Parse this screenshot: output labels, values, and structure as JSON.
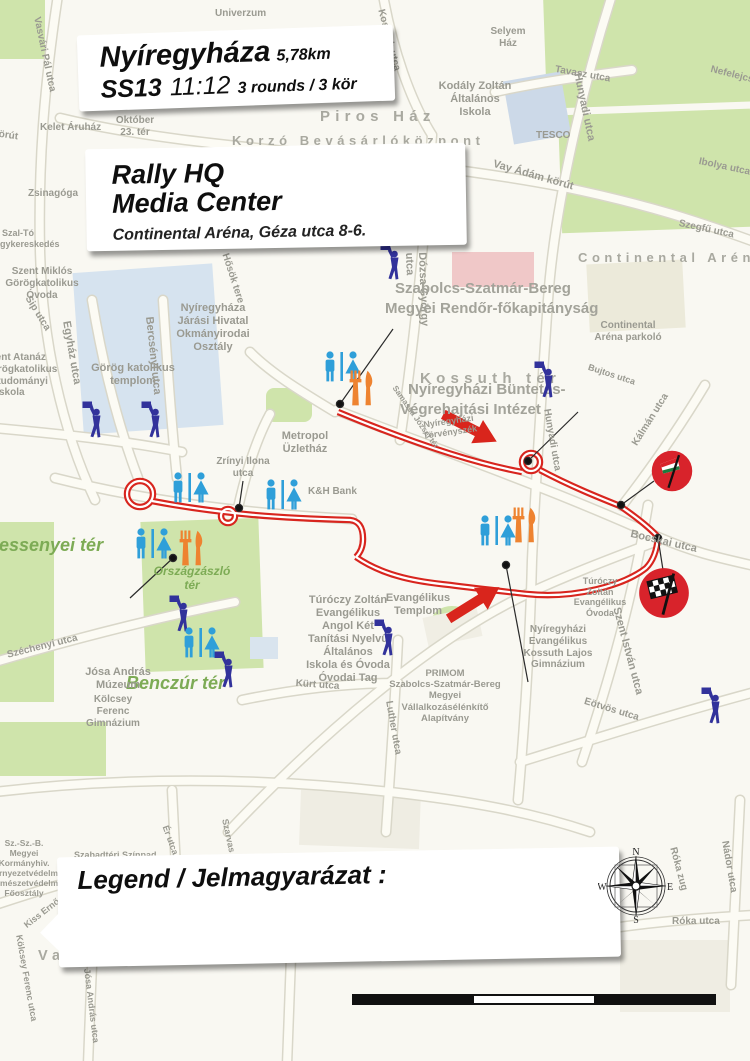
{
  "header": {
    "title": "Nyíregyháza",
    "distance": "5,78km",
    "stage": "SS13",
    "time": "11:12",
    "rounds": "3 rounds / 3 kör"
  },
  "hq": {
    "line1": "Rally HQ",
    "line2": "Media Center",
    "subtitle": "Continental Aréna, Géza utca 8-6."
  },
  "legend": {
    "title": "Legend / Jelmagyarázat :",
    "items": [
      {
        "icon": "spectator",
        "label": "Spectator spot / Nézői pont",
        "row": 0
      },
      {
        "icon": "roadclosed",
        "label": "Road closed  / Lezárt út",
        "row": 0
      },
      {
        "icon": "start",
        "label": "Start / Rajt",
        "row": 1
      },
      {
        "icon": "finish",
        "label": "Finish / Cél",
        "row": 1
      },
      {
        "icon": "buffet",
        "label": "Buffet / Büfé",
        "row": 1
      },
      {
        "icon": "toilet",
        "label": "Toilet / WC",
        "row": 1
      }
    ]
  },
  "scale_bar": {
    "labels": [
      {
        "t": "0",
        "x": 8
      },
      {
        "t": "200m",
        "x": 110
      },
      {
        "t": "400m",
        "x": 230
      },
      {
        "t": "600m",
        "x": 348
      }
    ]
  },
  "compass": {
    "n": "N",
    "e": "E",
    "s": "S",
    "w": "W"
  },
  "spots": [
    {
      "number": "13",
      "x": 506,
      "y": 682,
      "rot": -2,
      "sponsor": "tippmix"
    },
    {
      "number": "14",
      "x": 66,
      "y": 596,
      "rot": -4,
      "sponsor": "peugeot"
    },
    {
      "number": "15",
      "x": 188,
      "y": 398,
      "rot": -3,
      "sponsor": "wow"
    },
    {
      "number": "16",
      "x": 382,
      "y": 297,
      "rot": -1,
      "sponsor": null
    },
    {
      "number": "17",
      "x": 570,
      "y": 377,
      "rot": -2,
      "sponsor": "skoda"
    }
  ],
  "sponsors": {
    "wow": {
      "line1": "WOW",
      "line2": "HUNGARY"
    },
    "peugeot": {
      "name": "PEUGEOT"
    },
    "skoda": {
      "dealer": "Platán Autóház",
      "tagline": "Mindenünk az autó",
      "brand": "ŠKODA"
    },
    "tippmix": {
      "part1": "TiPP",
      "part2": "MIX"
    }
  },
  "route_notes": [
    {
      "t": "3x",
      "x": 446,
      "y": 383,
      "s": 26
    },
    {
      "t": "3x",
      "x": 448,
      "y": 622,
      "s": 23
    }
  ],
  "map_labels": [
    {
      "t": "Univerzum",
      "x": 215,
      "y": 8,
      "s": 10
    },
    {
      "t": "Selyem\nHáz",
      "x": 508,
      "y": 26,
      "s": 10,
      "c": "c"
    },
    {
      "t": "Kodály Zoltán\nÁltalános\nIskola",
      "x": 475,
      "y": 80,
      "s": 11,
      "c": "c"
    },
    {
      "t": "Tavasz utca",
      "x": 556,
      "y": 64,
      "s": 10,
      "r": 10
    },
    {
      "t": "TESCO",
      "x": 536,
      "y": 130,
      "s": 10
    },
    {
      "t": "Hunyadi utca",
      "x": 583,
      "y": 72,
      "s": 11,
      "r": 78
    },
    {
      "t": "Nefelejcs utca",
      "x": 712,
      "y": 64,
      "s": 10,
      "r": 14
    },
    {
      "t": "Ibolya utca",
      "x": 700,
      "y": 156,
      "s": 10,
      "r": 12
    },
    {
      "t": "Szegfű utca",
      "x": 680,
      "y": 218,
      "s": 10,
      "r": 12
    },
    {
      "t": "Vay Ádám körút",
      "x": 495,
      "y": 158,
      "s": 11,
      "r": 16
    },
    {
      "t": "körút",
      "x": -6,
      "y": 128,
      "s": 10,
      "r": 8
    },
    {
      "t": "Piros Ház",
      "x": 320,
      "y": 108,
      "s": 15,
      "c": "sp"
    },
    {
      "t": "Korzó Bevásárlóközpont",
      "x": 232,
      "y": 133,
      "s": 13,
      "c": "sp"
    },
    {
      "t": "Kelet Áruház",
      "x": 40,
      "y": 122,
      "s": 10
    },
    {
      "t": "Október\n23. tér",
      "x": 135,
      "y": 115,
      "s": 10,
      "c": "c"
    },
    {
      "t": "Zsinagóga",
      "x": 28,
      "y": 188,
      "s": 10
    },
    {
      "t": "Szal-Tó\nItalnagykereskedés",
      "x": 18,
      "y": 228,
      "s": 9,
      "c": "c"
    },
    {
      "t": "Szent Miklós\nGörögkatolikus\nÓvoda",
      "x": 42,
      "y": 266,
      "s": 10,
      "c": "c"
    },
    {
      "t": "Sip utca",
      "x": 32,
      "y": 294,
      "s": 10,
      "r": 58
    },
    {
      "t": "Szent Atanáz\nGörögkatolikus\nHittudományi\nFőiskola",
      "x": -16,
      "y": 352,
      "s": 10
    },
    {
      "t": "Egyház utca",
      "x": 72,
      "y": 320,
      "s": 11,
      "r": 80
    },
    {
      "t": "Bercsényi utca",
      "x": 155,
      "y": 316,
      "s": 11,
      "r": 84
    },
    {
      "t": "Görög katolikus\ntemplom",
      "x": 133,
      "y": 362,
      "s": 11,
      "c": "c"
    },
    {
      "t": "Nyíregyháza\nJárási Hivatal\nOkmányirodai\nOsztály",
      "x": 213,
      "y": 302,
      "s": 11,
      "c": "c"
    },
    {
      "t": "Hősök tere",
      "x": 230,
      "y": 252,
      "s": 10,
      "r": 72
    },
    {
      "t": "Kossuth tér",
      "x": 420,
      "y": 370,
      "s": 15,
      "c": "sp"
    },
    {
      "t": "Metropol\nÜzletház",
      "x": 305,
      "y": 430,
      "s": 11,
      "c": "c"
    },
    {
      "t": "Zrínyi Ilona\nutca",
      "x": 243,
      "y": 456,
      "s": 10,
      "c": "c"
    },
    {
      "t": "K&H Bank",
      "x": 308,
      "y": 486,
      "s": 10
    },
    {
      "t": "Dózsa György\nutca",
      "x": 428,
      "y": 252,
      "s": 11,
      "r": 88
    },
    {
      "t": "Szabolcs-Szatmár-Bereg",
      "x": 395,
      "y": 280,
      "s": 15,
      "c": "b"
    },
    {
      "t": "Megyei Rendőr-főkapitányság",
      "x": 385,
      "y": 300,
      "s": 15,
      "c": "b"
    },
    {
      "t": "Continental Aréna",
      "x": 578,
      "y": 250,
      "s": 13,
      "c": "sp"
    },
    {
      "t": "Continental\nAréna parkoló",
      "x": 628,
      "y": 320,
      "s": 10,
      "c": "c"
    },
    {
      "t": "Nyíregyházi Büntetés-",
      "x": 408,
      "y": 381,
      "s": 15,
      "c": "b"
    },
    {
      "t": "Végrehajtási Intézet",
      "x": 400,
      "y": 401,
      "s": 15,
      "c": "b"
    },
    {
      "t": "Nyíregyházi\nTörvényszék",
      "x": 448,
      "y": 420,
      "s": 9,
      "r": -8,
      "c": "c"
    },
    {
      "t": "Hunyadi utca",
      "x": 552,
      "y": 408,
      "s": 10,
      "r": 80
    },
    {
      "t": "Bujtos utca",
      "x": 590,
      "y": 362,
      "s": 9,
      "r": 18
    },
    {
      "t": "Samassa József tér",
      "x": 398,
      "y": 384,
      "s": 8,
      "r": 55
    },
    {
      "t": "Bocskai utca",
      "x": 632,
      "y": 528,
      "s": 11,
      "r": 13
    },
    {
      "t": "Kálmán utca",
      "x": 630,
      "y": 442,
      "s": 10,
      "r": -58
    },
    {
      "t": "Szent István utca",
      "x": 622,
      "y": 606,
      "s": 11,
      "r": 75
    },
    {
      "t": "Eötvös utca",
      "x": 586,
      "y": 696,
      "s": 10,
      "r": 17
    },
    {
      "t": "Bessenyei tér",
      "x": -14,
      "y": 535,
      "s": 18,
      "c": "grn"
    },
    {
      "t": "Országzászló\ntér",
      "x": 192,
      "y": 564,
      "s": 12,
      "c": "grn c"
    },
    {
      "t": "Benczúr tér",
      "x": 126,
      "y": 673,
      "s": 18,
      "c": "grn"
    },
    {
      "t": "Széchenyi utca",
      "x": 6,
      "y": 650,
      "s": 10,
      "r": -14
    },
    {
      "t": "Kürt utca",
      "x": 296,
      "y": 678,
      "s": 10,
      "r": 4
    },
    {
      "t": "Luther utca",
      "x": 394,
      "y": 700,
      "s": 10,
      "r": 80
    },
    {
      "t": "Evangélikus\nTemplom",
      "x": 418,
      "y": 592,
      "s": 11,
      "c": "c"
    },
    {
      "t": "Túróczy Zoltán\nEvangélikus\nAngol Két\nTanítási Nyelvű\nÁltalános\nIskola és Óvoda\nÓvodai Tag",
      "x": 348,
      "y": 594,
      "s": 11,
      "c": "c"
    },
    {
      "t": "PRIMOM\nSzabolcs-Szatmár-Bereg\nMegyei\nVállalkozásélénkítő\nAlapítvány",
      "x": 445,
      "y": 668,
      "s": 9.5,
      "c": "c"
    },
    {
      "t": "Nyíregyházi\nEvangélikus\nKossuth Lajos\nGimnázium",
      "x": 558,
      "y": 624,
      "s": 10,
      "c": "c"
    },
    {
      "t": "Túróczy\nZoltán\nEvangélikus\nÓvoda",
      "x": 600,
      "y": 576,
      "s": 9,
      "c": "c"
    },
    {
      "t": "Kölcsey\nFerenc\nGimnázium",
      "x": 113,
      "y": 694,
      "s": 10,
      "c": "c"
    },
    {
      "t": "Jósa András\nMúzeum",
      "x": 118,
      "y": 666,
      "s": 11,
      "c": "c"
    },
    {
      "t": "Sz.-Sz.-B.\nMegyei\nKormányhiv.\nKörnyezetvédelmi\nTermészetvédelmi\nFőosztály",
      "x": 24,
      "y": 838,
      "s": 8.5,
      "c": "c"
    },
    {
      "t": "Szabadtéri Színpad",
      "x": 74,
      "y": 850,
      "s": 9
    },
    {
      "t": "Vasvári Pál Gimnázium",
      "x": 38,
      "y": 948,
      "s": 14.5,
      "c": "sp"
    },
    {
      "t": "Róka zug",
      "x": 678,
      "y": 846,
      "s": 10,
      "r": 75
    },
    {
      "t": "Nádor utca",
      "x": 730,
      "y": 840,
      "s": 10,
      "r": 80
    },
    {
      "t": "Róka utca",
      "x": 672,
      "y": 916,
      "s": 10
    },
    {
      "t": "Ér utca",
      "x": 170,
      "y": 824,
      "s": 9,
      "r": 70
    },
    {
      "t": "Szarvas utca",
      "x": 230,
      "y": 818,
      "s": 9,
      "r": 78
    },
    {
      "t": "Vasvári Pál utca",
      "x": 42,
      "y": 16,
      "s": 10,
      "r": 78
    },
    {
      "t": "Kossuth utca",
      "x": 386,
      "y": 8,
      "s": 10,
      "r": 75
    },
    {
      "t": "Kiss Ernő utca",
      "x": 22,
      "y": 922,
      "s": 9,
      "r": -38
    },
    {
      "t": "Kölcsey Ferenc utca",
      "x": 24,
      "y": 934,
      "s": 9,
      "r": 80
    },
    {
      "t": "Jósa András utca",
      "x": 92,
      "y": 968,
      "s": 9,
      "r": 83
    }
  ],
  "map_icons": [
    {
      "type": "roadclosed",
      "x": 391,
      "y": 262
    },
    {
      "type": "roadclosed",
      "x": 93,
      "y": 420
    },
    {
      "type": "roadclosed",
      "x": 152,
      "y": 420
    },
    {
      "type": "roadclosed",
      "x": 545,
      "y": 380
    },
    {
      "type": "roadclosed",
      "x": 180,
      "y": 614
    },
    {
      "type": "roadclosed",
      "x": 225,
      "y": 670
    },
    {
      "type": "roadclosed",
      "x": 385,
      "y": 638
    },
    {
      "type": "roadclosed",
      "x": 712,
      "y": 706
    },
    {
      "type": "toilet",
      "x": 342,
      "y": 366
    },
    {
      "type": "toilet",
      "x": 190,
      "y": 487
    },
    {
      "type": "toilet",
      "x": 283,
      "y": 494
    },
    {
      "type": "toilet",
      "x": 497,
      "y": 530
    },
    {
      "type": "toilet",
      "x": 153,
      "y": 543
    },
    {
      "type": "toilet",
      "x": 201,
      "y": 642
    },
    {
      "type": "buffet",
      "x": 361,
      "y": 388
    },
    {
      "type": "buffet",
      "x": 524,
      "y": 525
    },
    {
      "type": "buffet",
      "x": 191,
      "y": 548
    },
    {
      "type": "start",
      "x": 672,
      "y": 471
    },
    {
      "type": "finish",
      "x": 664,
      "y": 593
    }
  ],
  "callouts": [
    [
      393,
      329,
      340,
      404
    ],
    [
      243,
      481,
      239,
      508
    ],
    [
      578,
      412,
      528,
      461
    ],
    [
      528,
      682,
      506,
      565
    ],
    [
      130,
      598,
      173,
      558
    ],
    [
      654,
      481,
      621,
      505
    ],
    [
      663,
      570,
      658,
      538
    ]
  ],
  "colors": {
    "route_red": "#d8251e",
    "spot_yellow": "#f8e41b",
    "toilet_blue": "#2f9fd9",
    "buffet_orange": "#ee8330",
    "closed_navy": "#32329b",
    "start_finish_red": "#d8232b",
    "park_green": "#cfe4ab"
  }
}
